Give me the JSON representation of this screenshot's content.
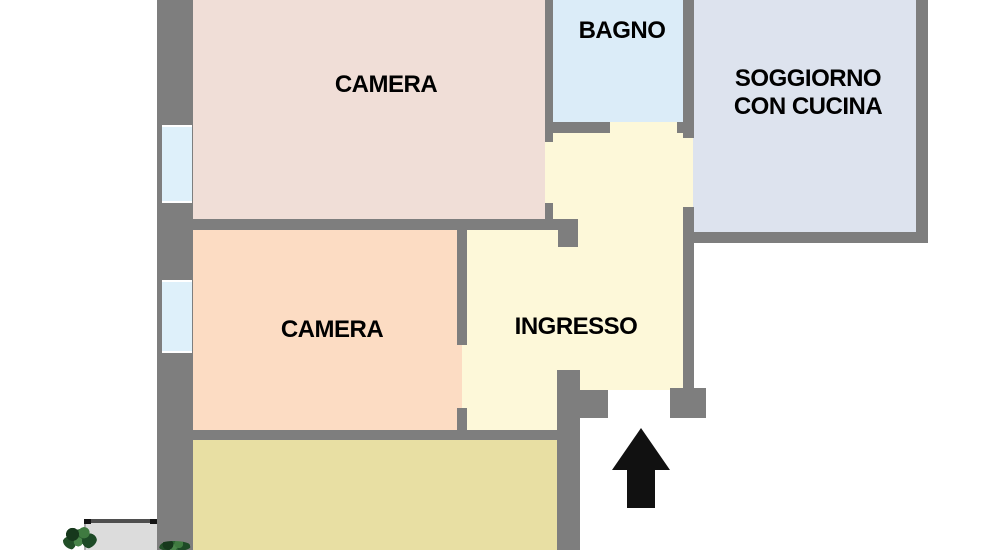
{
  "plan": {
    "name": "apartment-floor-plan",
    "rooms": {
      "camera_top": {
        "label": "CAMERA"
      },
      "bagno": {
        "label": "BAGNO"
      },
      "soggiorno": {
        "label_line1": "SOGGIORNO",
        "label_line2": "CON CUCINA"
      },
      "camera_mid": {
        "label": "CAMERA"
      },
      "ingresso": {
        "label": "INGRESSO"
      }
    },
    "icons": {
      "entrance_arrow": "up-arrow-entrance",
      "plant": "green-plant",
      "windows": "window-opening"
    }
  },
  "colors": {
    "background": "#ffffff",
    "wall": "#7e7e7e",
    "camera_top": "#f0ded7",
    "camera_mid": "#fcdcc3",
    "bagno": "#dbecf8",
    "soggiorno": "#dde3ee",
    "ingresso": "#fdf8d9",
    "utility": "#e8dfa3",
    "window": "#def0fa",
    "balcony": "#dcdcdc",
    "plant": "#2b6132",
    "arrow": "#111111",
    "label_text": "#000000"
  }
}
